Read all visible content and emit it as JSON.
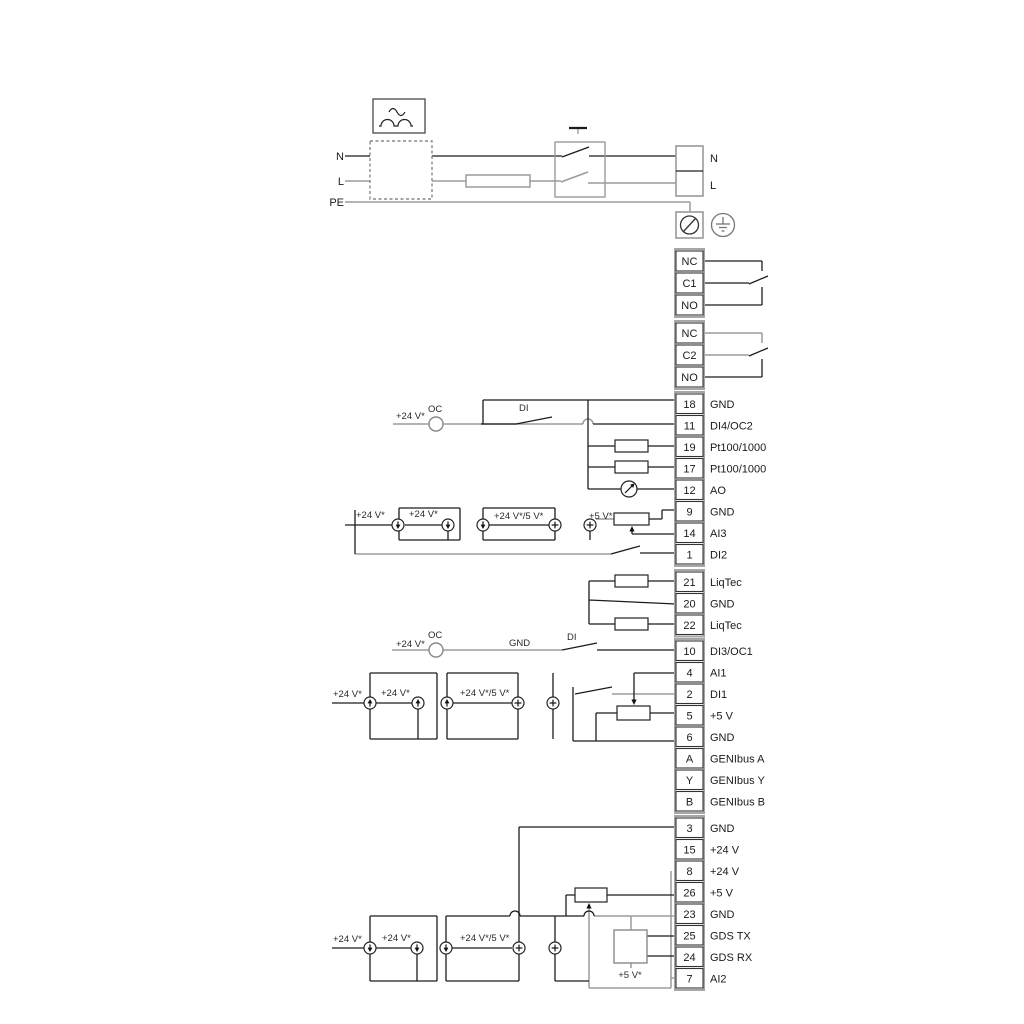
{
  "power": {
    "n_left": "N",
    "l_left": "L",
    "pe": "PE",
    "n_right": "N",
    "l_right": "L"
  },
  "relays": [
    {
      "name": "relay-1",
      "cells": [
        "NC",
        "C1",
        "NO"
      ]
    },
    {
      "name": "relay-2",
      "cells": [
        "NC",
        "C2",
        "NO"
      ]
    }
  ],
  "strips": [
    {
      "name": "io-strip-a",
      "terminals": [
        [
          "18",
          "GND"
        ],
        [
          "11",
          "DI4/OC2"
        ],
        [
          "19",
          "Pt100/1000"
        ],
        [
          "17",
          "Pt100/1000"
        ],
        [
          "12",
          "AO"
        ],
        [
          "9",
          "GND"
        ],
        [
          "14",
          "AI3"
        ],
        [
          "1",
          "DI2"
        ]
      ]
    },
    {
      "name": "liqtec-strip",
      "terminals": [
        [
          "21",
          "LiqTec"
        ],
        [
          "20",
          "GND"
        ],
        [
          "22",
          "LiqTec"
        ]
      ]
    },
    {
      "name": "io-strip-b",
      "terminals": [
        [
          "10",
          "DI3/OC1"
        ],
        [
          "4",
          "AI1"
        ],
        [
          "2",
          "DI1"
        ],
        [
          "5",
          "+5 V"
        ],
        [
          "6",
          "GND"
        ],
        [
          "A",
          "GENIbus A"
        ],
        [
          "Y",
          "GENIbus Y"
        ],
        [
          "B",
          "GENIbus B"
        ]
      ]
    },
    {
      "name": "io-strip-c",
      "terminals": [
        [
          "3",
          "GND"
        ],
        [
          "15",
          "+24 V"
        ],
        [
          "8",
          "+24 V"
        ],
        [
          "26",
          "+5 V"
        ],
        [
          "23",
          "GND"
        ],
        [
          "25",
          "GDS TX"
        ],
        [
          "24",
          "GDS RX"
        ],
        [
          "7",
          "AI2"
        ]
      ]
    }
  ],
  "labels": {
    "v24": "+24 V*",
    "oc": "OC",
    "di": "DI",
    "gnd": "GND",
    "v24_5": "+24 V*/5 V*",
    "v5s": "+5 V*"
  }
}
